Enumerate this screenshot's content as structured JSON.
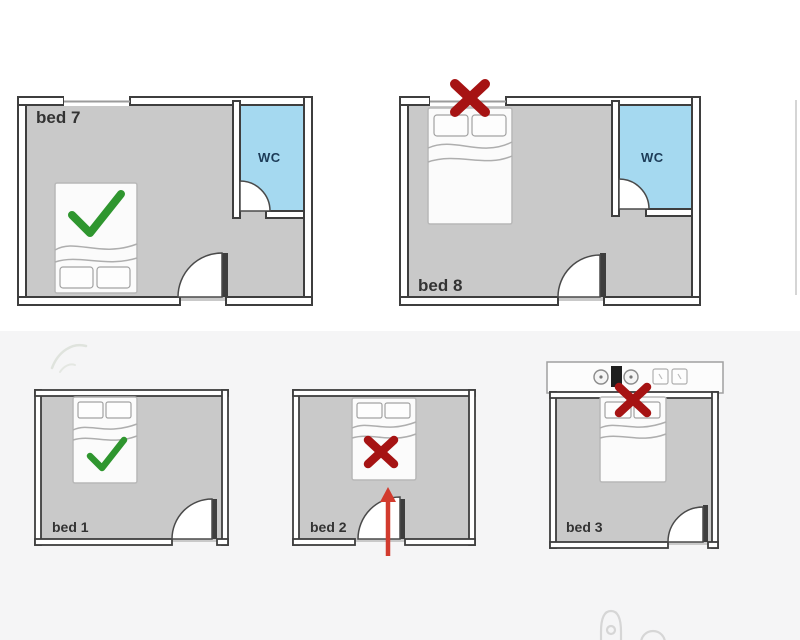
{
  "page": {
    "background_top": "#ffffff",
    "background_bottom": "#f5f5f6",
    "description_labels": {
      "bed7": "bed 7",
      "bed8": "bed 8",
      "bed1": "bed 1",
      "bed2": "bed 2",
      "bed3": "bed 3",
      "wc7": "WC",
      "wc8": "WC"
    }
  },
  "colors": {
    "wall": "#3e3e3e",
    "floor": "#c9c9c9",
    "wc_fill": "#a5d9f0",
    "wc_text": "#1c3b57",
    "label_text": "#333333",
    "check_green": "#2f962f",
    "cross_red": "#a61313",
    "arrow_red": "#d23b2e"
  },
  "plans": {
    "bed7": {
      "label": "bed 7",
      "wc_label": "WC",
      "verdict": "good",
      "verdict_icon": "check-icon",
      "features": [
        "window-top-left",
        "wc-top-right",
        "door-bottom",
        "bed-bottom-left"
      ]
    },
    "bed8": {
      "label": "bed 8",
      "wc_label": "WC",
      "verdict": "bad",
      "verdict_icon": "cross-icon",
      "features": [
        "window-top-with-cross",
        "wc-top-right",
        "door-bottom",
        "bed-under-window"
      ]
    },
    "bed1": {
      "label": "bed 1",
      "verdict": "good",
      "verdict_icon": "check-icon",
      "features": [
        "bed-top",
        "door-bottom-right"
      ]
    },
    "bed2": {
      "label": "bed 2",
      "verdict": "bad",
      "verdict_icon": "cross-icon",
      "features": [
        "bed-top-facing-door",
        "door-bottom-center",
        "arrow-from-door-to-bed"
      ]
    },
    "bed3": {
      "label": "bed 3",
      "verdict": "bad",
      "verdict_icon": "cross-icon",
      "features": [
        "outlet-strip-above-headboard",
        "bed-top",
        "door-bottom-right"
      ]
    }
  }
}
